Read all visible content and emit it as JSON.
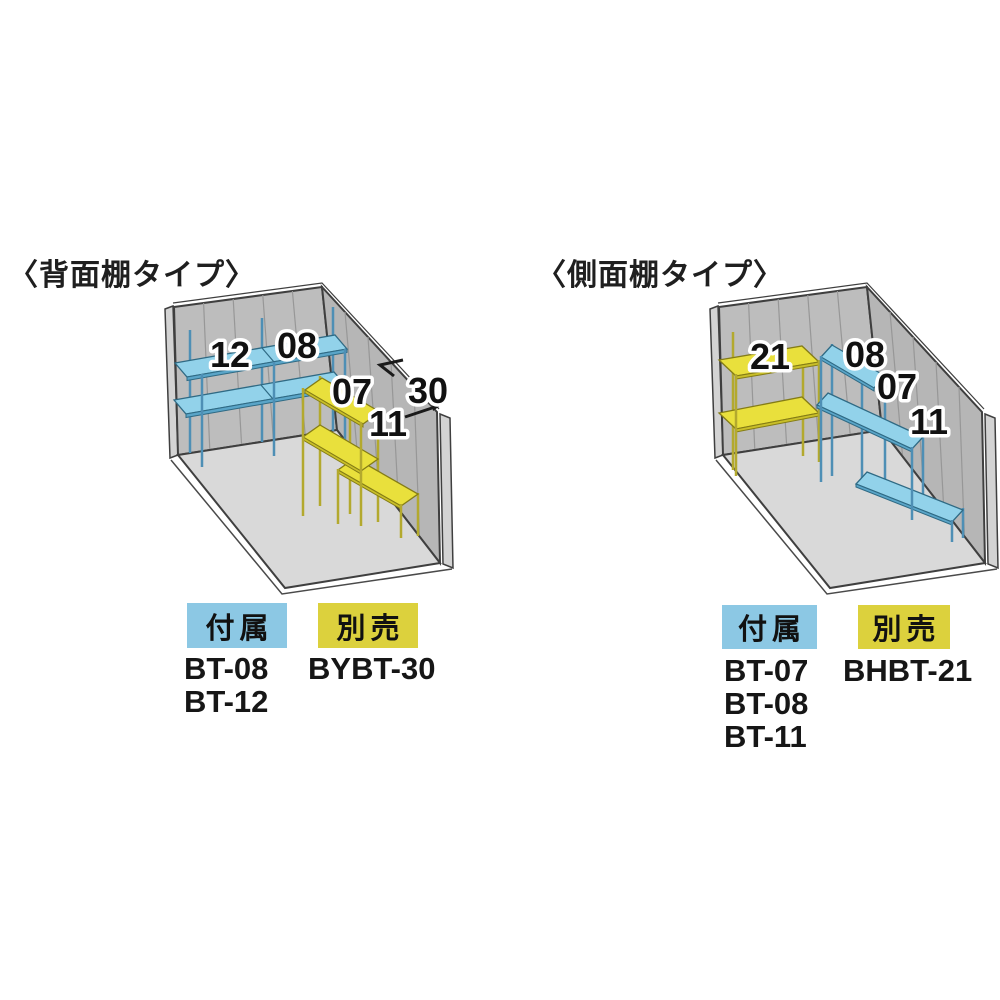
{
  "colors": {
    "badge_blue": "#8cc8e4",
    "badge_yellow": "#dcd13d",
    "shelf_blue": "#92d2ea",
    "shelf_yellow": "#e9e03c",
    "wall_gray": "#bdbdbd",
    "floor_gray": "#d9d9d9",
    "text": "#1a1a1a"
  },
  "diagrams": [
    {
      "title": "〈背面棚タイプ〉",
      "back_wall_shelf_labels": [
        "12",
        "08"
      ],
      "side_wall_shelf_labels": [
        "07",
        "11"
      ],
      "span_label": "30",
      "included": {
        "label": "付属",
        "items": [
          "BT-08",
          "BT-12"
        ]
      },
      "sold_separately": {
        "label": "別売",
        "items": [
          "BYBT-30"
        ]
      }
    },
    {
      "title": "〈側面棚タイプ〉",
      "back_wall_shelf_labels": [
        "21"
      ],
      "side_wall_shelf_labels": [
        "08",
        "07",
        "11"
      ],
      "included": {
        "label": "付属",
        "items": [
          "BT-07",
          "BT-08",
          "BT-11"
        ]
      },
      "sold_separately": {
        "label": "別売",
        "items": [
          "BHBT-21"
        ]
      }
    }
  ]
}
